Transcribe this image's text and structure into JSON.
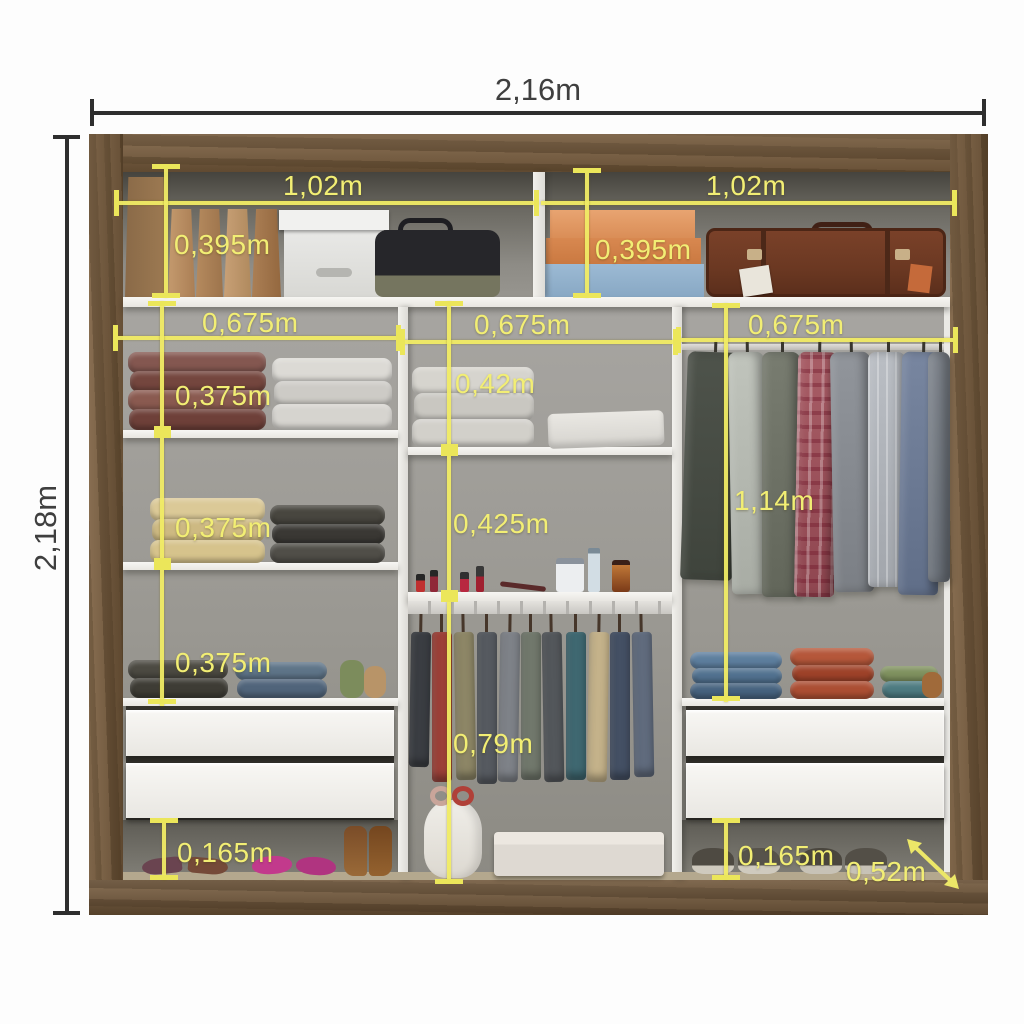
{
  "diagram": {
    "overall": {
      "width": "2,16m",
      "height": "2,18m",
      "depth": "0,52m"
    },
    "top_shelf": {
      "left_width": "1,02m",
      "right_width": "1,02m",
      "left_height": "0,395m",
      "right_height": "0,395m"
    },
    "column_widths": {
      "left": "0,675m",
      "middle": "0,675m",
      "right": "0,675m"
    },
    "left_column": {
      "section1": "0,375m",
      "section2": "0,375m",
      "section3": "0,375m",
      "shoe_space": "0,165m"
    },
    "middle_column": {
      "upper": "0,42m",
      "lower": "0,425m",
      "hanging": "0,79m"
    },
    "right_column": {
      "hanging": "1,14m",
      "shoe_space": "0,165m"
    }
  },
  "colors": {
    "dimension_accent": "#ece768",
    "outer_dimension": "#3f3f3f",
    "wood": "#6f5638",
    "shelf": "#f2f1ee",
    "interior": "#9a9893"
  }
}
